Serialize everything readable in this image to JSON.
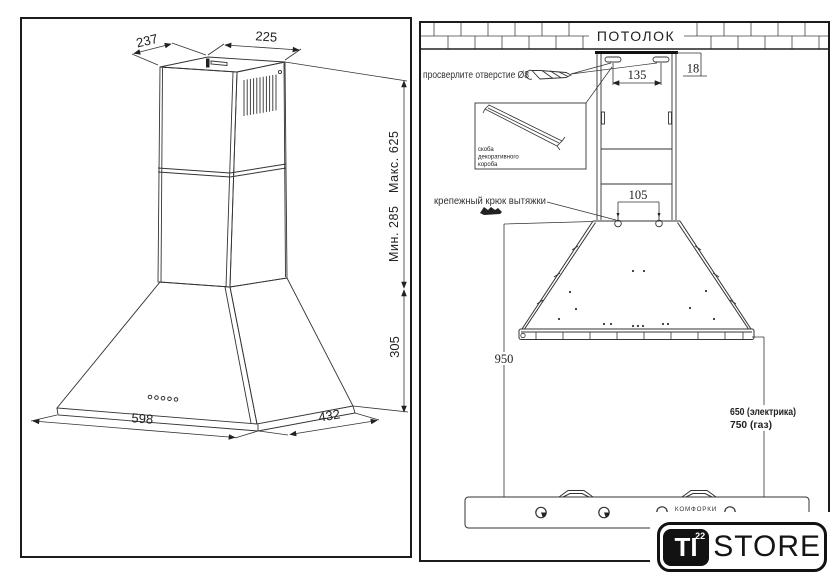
{
  "left_panel": {
    "dims": {
      "top_depth": "237",
      "top_width": "225",
      "height_max": "Макс. 625",
      "height_min": "Мин. 285",
      "canopy_height": "305",
      "front_width": "598",
      "side_depth": "432"
    }
  },
  "right_panel": {
    "ceiling_label": "ПОТОЛОК",
    "drill_hole_label": "просверлите отверстие Ø8",
    "bracket_caption": [
      "скоба",
      "декоративного",
      "короба"
    ],
    "hook_label": "крепежный крюк вытяжки",
    "burners_label": "КОМФОРКИ",
    "dims": {
      "bracket_holes": "135",
      "ceiling_gap": "18",
      "hooks": "105",
      "canopy_to_hob": "950",
      "electric": "650 (электрика)",
      "gas": "750 (газ)"
    }
  },
  "logo": {
    "badge": "TI",
    "badge_sup": "22",
    "wordmark": "STORE"
  }
}
